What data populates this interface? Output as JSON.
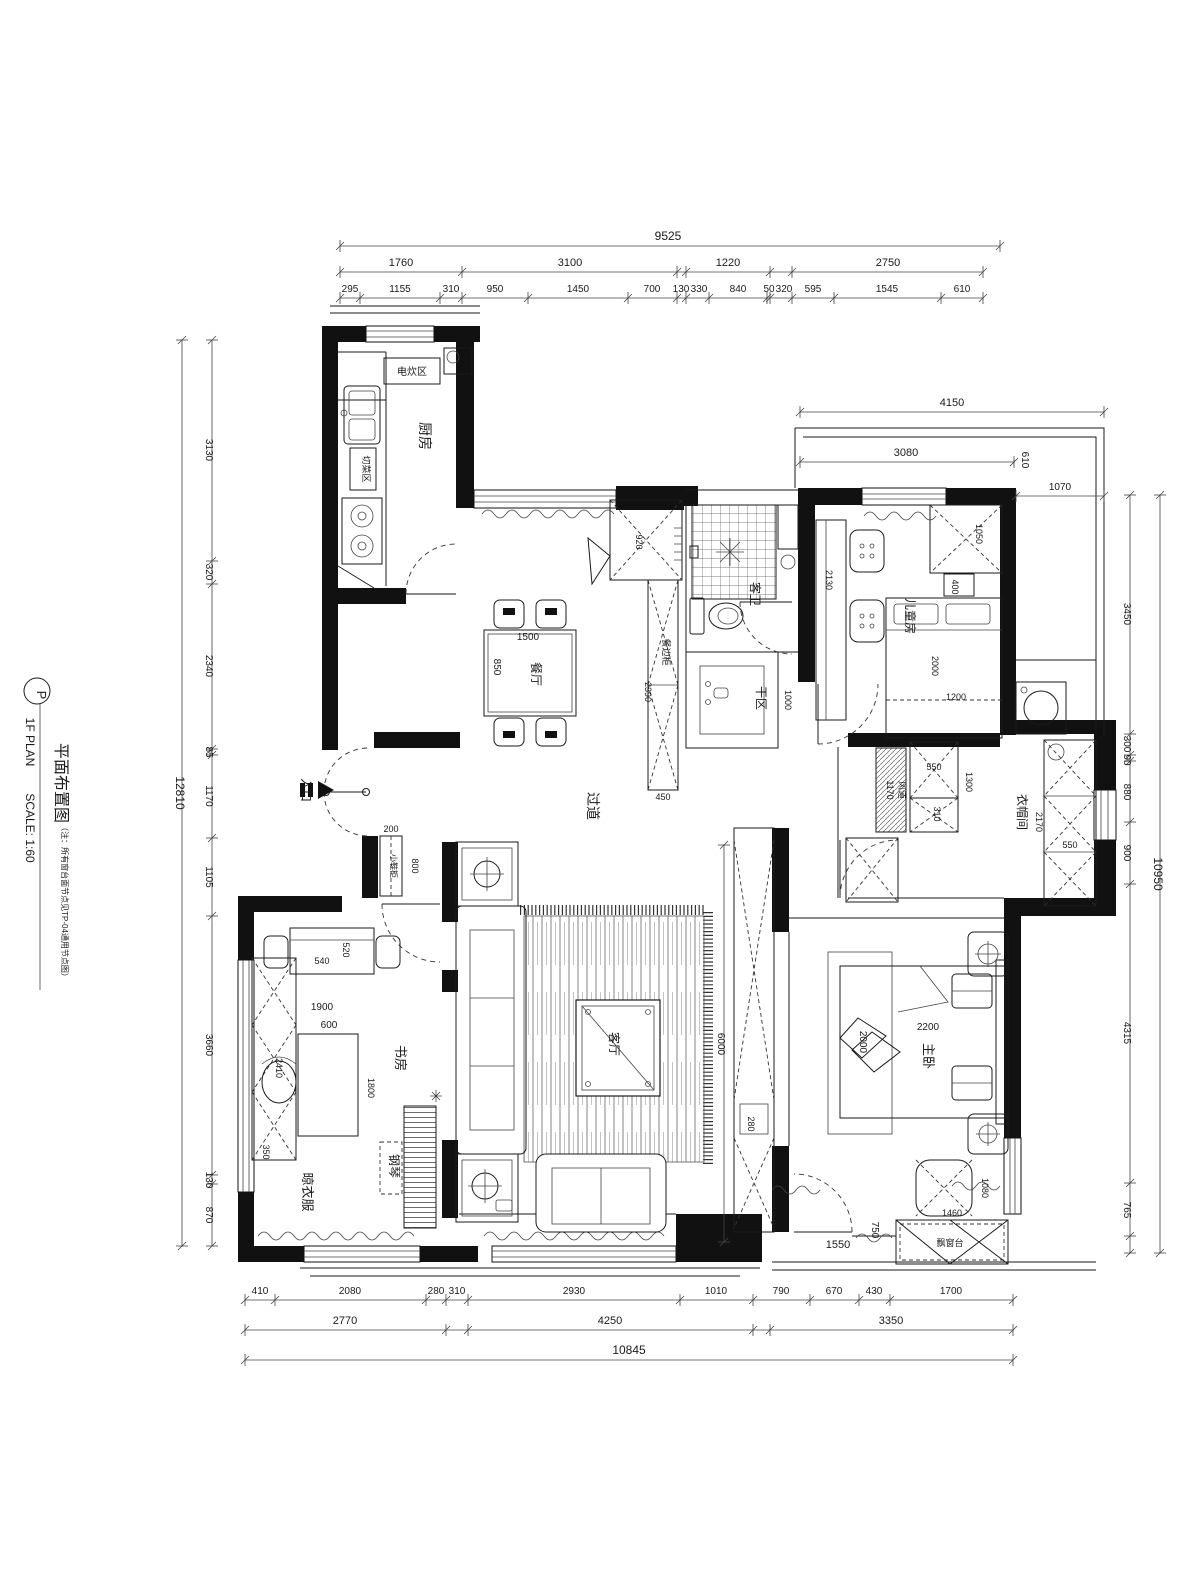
{
  "annotations": {
    "title": [
      {
        "t": "P",
        "x": 37,
        "y": 695,
        "r": 90,
        "s": 13,
        "n": "title-marker-letter"
      },
      {
        "t": "1F PLAN",
        "x": 26,
        "y": 742,
        "r": 90,
        "s": 12,
        "n": "title-line1"
      },
      {
        "t": "SCALE: 1:60",
        "x": 26,
        "y": 828,
        "r": 90,
        "s": 12,
        "n": "title-scale"
      },
      {
        "t": "平面布置图",
        "x": 56,
        "y": 783,
        "r": 90,
        "s": 16,
        "n": "title-cn"
      },
      {
        "t": "（注：所有窗台面节点见TP-04通用节点图）",
        "x": 62,
        "y": 902,
        "r": 90,
        "s": 8,
        "n": "title-note"
      }
    ],
    "rooms": [
      {
        "t": "厨房",
        "x": 420,
        "y": 436,
        "r": 90,
        "s": 14,
        "n": "room-kitchen"
      },
      {
        "t": "电炊区",
        "x": 412,
        "y": 375,
        "r": 0,
        "s": 10,
        "n": "label-cooking-zone"
      },
      {
        "t": "切菜区",
        "x": 363,
        "y": 469,
        "r": 90,
        "s": 9,
        "n": "label-cutting-zone"
      },
      {
        "t": "餐厅",
        "x": 532,
        "y": 674,
        "r": 90,
        "s": 12,
        "n": "room-dining"
      },
      {
        "t": "客卫",
        "x": 751,
        "y": 594,
        "r": 90,
        "s": 12,
        "n": "room-guest-bath"
      },
      {
        "t": "干区",
        "x": 757,
        "y": 698,
        "r": 90,
        "s": 12,
        "n": "room-dry-area"
      },
      {
        "t": "过道",
        "x": 588,
        "y": 806,
        "r": 90,
        "s": 14,
        "n": "room-corridor"
      },
      {
        "t": "入口",
        "x": 302,
        "y": 790,
        "r": 90,
        "s": 12,
        "n": "label-entrance"
      },
      {
        "t": "儿童房",
        "x": 906,
        "y": 616,
        "r": 90,
        "s": 12,
        "n": "room-kids"
      },
      {
        "t": "衣帽间",
        "x": 1018,
        "y": 812,
        "r": 90,
        "s": 12,
        "n": "room-cloakroom"
      },
      {
        "t": "客厅",
        "x": 610,
        "y": 1044,
        "r": 90,
        "s": 12,
        "n": "room-living"
      },
      {
        "t": "书房",
        "x": 396,
        "y": 1058,
        "r": 90,
        "s": 13,
        "n": "room-study"
      },
      {
        "t": "晾衣服",
        "x": 303,
        "y": 1192,
        "r": 90,
        "s": 13,
        "n": "label-laundry"
      },
      {
        "t": "钢琴",
        "x": 390,
        "y": 1166,
        "r": 90,
        "s": 12,
        "n": "label-piano"
      },
      {
        "t": "主卧",
        "x": 924,
        "y": 1056,
        "r": 90,
        "s": 13,
        "n": "room-master"
      },
      {
        "t": "飘窗台",
        "x": 950,
        "y": 1246,
        "r": 0,
        "s": 9,
        "n": "label-bay-window"
      },
      {
        "t": "风道",
        "x": 899,
        "y": 790,
        "r": 90,
        "s": 9,
        "n": "label-air-duct"
      },
      {
        "t": "小鞋柜",
        "x": 391,
        "y": 866,
        "r": 90,
        "s": 8,
        "n": "label-shoe-cabinet"
      },
      {
        "t": "餐边柜",
        "x": 663,
        "y": 652,
        "r": 90,
        "s": 9,
        "n": "label-sideboard"
      }
    ],
    "dims": [
      {
        "t": "920",
        "x": 636,
        "y": 542,
        "r": 90,
        "s": 9,
        "n": "dim-920"
      },
      {
        "t": "1500",
        "x": 528,
        "y": 640,
        "r": 0,
        "s": 10,
        "n": "dim-1500"
      },
      {
        "t": "850",
        "x": 494,
        "y": 667,
        "r": 90,
        "s": 10,
        "n": "dim-850"
      },
      {
        "t": "2390",
        "x": 645,
        "y": 692,
        "r": 90,
        "s": 9,
        "n": "dim-2390"
      },
      {
        "t": "450",
        "x": 663,
        "y": 800,
        "r": 0,
        "s": 9,
        "n": "dim-450"
      },
      {
        "t": "1000",
        "x": 785,
        "y": 700,
        "r": 90,
        "s": 9,
        "n": "dim-1000"
      },
      {
        "t": "2130",
        "x": 826,
        "y": 580,
        "r": 90,
        "s": 9,
        "n": "dim-2130"
      },
      {
        "t": "1050",
        "x": 976,
        "y": 534,
        "r": 90,
        "s": 9,
        "n": "dim-1050"
      },
      {
        "t": "400",
        "x": 952,
        "y": 587,
        "r": 90,
        "s": 9,
        "n": "dim-400"
      },
      {
        "t": "2000",
        "x": 932,
        "y": 666,
        "r": 90,
        "s": 9,
        "n": "dim-2000-kids"
      },
      {
        "t": "1200",
        "x": 956,
        "y": 700,
        "r": 0,
        "s": 9,
        "n": "dim-1200"
      },
      {
        "t": "200",
        "x": 391,
        "y": 832,
        "r": 0,
        "s": 9,
        "n": "dim-200"
      },
      {
        "t": "800",
        "x": 412,
        "y": 866,
        "r": 90,
        "s": 9,
        "n": "dim-800"
      },
      {
        "t": "540",
        "x": 322,
        "y": 964,
        "r": 0,
        "s": 9,
        "n": "dim-540"
      },
      {
        "t": "520",
        "x": 343,
        "y": 950,
        "r": 90,
        "s": 9,
        "n": "dim-520"
      },
      {
        "t": "1900",
        "x": 322,
        "y": 1010,
        "r": 0,
        "s": 10,
        "n": "dim-1900"
      },
      {
        "t": "600",
        "x": 329,
        "y": 1028,
        "r": 0,
        "s": 10,
        "n": "dim-600"
      },
      {
        "t": "1800",
        "x": 368,
        "y": 1088,
        "r": 90,
        "s": 9,
        "n": "dim-1800"
      },
      {
        "t": "2410",
        "x": 276,
        "y": 1068,
        "r": 90,
        "s": 9,
        "n": "dim-2410"
      },
      {
        "t": "350",
        "x": 263,
        "y": 1152,
        "r": 90,
        "s": 9,
        "n": "dim-350"
      },
      {
        "t": "550",
        "x": 934,
        "y": 770,
        "r": 0,
        "s": 9,
        "n": "dim-550-a"
      },
      {
        "t": "1300",
        "x": 966,
        "y": 782,
        "r": 90,
        "s": 9,
        "n": "dim-1300"
      },
      {
        "t": "310",
        "x": 934,
        "y": 814,
        "r": 90,
        "s": 9,
        "n": "dim-310"
      },
      {
        "t": "1170",
        "x": 887,
        "y": 790,
        "r": 90,
        "s": 9,
        "n": "dim-1170"
      },
      {
        "t": "2170",
        "x": 1036,
        "y": 822,
        "r": 90,
        "s": 9,
        "n": "dim-2170"
      },
      {
        "t": "550",
        "x": 1070,
        "y": 848,
        "r": 0,
        "s": 9,
        "n": "dim-550-b"
      },
      {
        "t": "280",
        "x": 748,
        "y": 1124,
        "r": 90,
        "s": 9,
        "n": "dim-280"
      },
      {
        "t": "2200",
        "x": 928,
        "y": 1030,
        "r": 0,
        "s": 10,
        "n": "dim-2200"
      },
      {
        "t": "2000",
        "x": 860,
        "y": 1042,
        "r": 90,
        "s": 10,
        "n": "dim-2000-master"
      },
      {
        "t": "1080",
        "x": 982,
        "y": 1188,
        "r": 90,
        "s": 9,
        "n": "dim-1080"
      },
      {
        "t": "1460",
        "x": 952,
        "y": 1216,
        "r": 0,
        "s": 9,
        "n": "dim-1460"
      },
      {
        "t": "1550",
        "x": 838,
        "y": 1248,
        "r": 0,
        "s": 11,
        "n": "dim-1550"
      },
      {
        "t": "750",
        "x": 872,
        "y": 1230,
        "r": 90,
        "s": 10,
        "n": "dim-750"
      }
    ]
  },
  "dim_chains": [
    {
      "n": "chain-top-overall",
      "o": "h",
      "p": 246,
      "a": 340,
      "b": 1000,
      "ticks": [
        340,
        1000
      ],
      "labels": [
        {
          "t": "9525",
          "x": 668,
          "y": 240,
          "s": 12
        }
      ]
    },
    {
      "n": "chain-top-mid",
      "o": "h",
      "p": 272,
      "a": 340,
      "b": 983,
      "ticks": [
        340,
        462,
        677,
        686,
        770,
        792,
        983
      ],
      "labels": [
        {
          "t": "1760",
          "x": 401,
          "y": 266,
          "s": 11
        },
        {
          "t": "3100",
          "x": 570,
          "y": 266,
          "s": 11
        },
        {
          "t": "1220",
          "x": 728,
          "y": 266,
          "s": 11
        },
        {
          "t": "2750",
          "x": 888,
          "y": 266,
          "s": 11
        }
      ]
    },
    {
      "n": "chain-top-detail",
      "o": "h",
      "p": 298,
      "a": 340,
      "b": 983,
      "ticks": [
        340,
        360,
        440,
        462,
        528,
        628,
        677,
        686,
        709,
        767,
        770,
        792,
        834,
        941,
        983
      ],
      "labels": [
        {
          "t": "295",
          "x": 350,
          "y": 292,
          "s": 10
        },
        {
          "t": "1155",
          "x": 400,
          "y": 292,
          "s": 10
        },
        {
          "t": "310",
          "x": 451,
          "y": 292,
          "s": 10
        },
        {
          "t": "950",
          "x": 495,
          "y": 292,
          "s": 10
        },
        {
          "t": "1450",
          "x": 578,
          "y": 292,
          "s": 10
        },
        {
          "t": "700",
          "x": 652,
          "y": 292,
          "s": 10
        },
        {
          "t": "130",
          "x": 681,
          "y": 292,
          "s": 10
        },
        {
          "t": "330",
          "x": 699,
          "y": 292,
          "s": 10
        },
        {
          "t": "840",
          "x": 738,
          "y": 292,
          "s": 10
        },
        {
          "t": "50",
          "x": 769,
          "y": 292,
          "s": 10
        },
        {
          "t": "320",
          "x": 784,
          "y": 292,
          "s": 10
        },
        {
          "t": "595",
          "x": 813,
          "y": 292,
          "s": 10
        },
        {
          "t": "1545",
          "x": 887,
          "y": 292,
          "s": 10
        },
        {
          "t": "610",
          "x": 962,
          "y": 292,
          "s": 10
        }
      ]
    },
    {
      "n": "chain-left-overall",
      "o": "v",
      "p": 182,
      "a": 340,
      "b": 1246,
      "ticks": [
        340,
        1246
      ],
      "labels": [
        {
          "t": "12810",
          "x": 176,
          "y": 793,
          "r": 90,
          "s": 12
        }
      ]
    },
    {
      "n": "chain-left-detail",
      "o": "v",
      "p": 212,
      "a": 340,
      "b": 1246,
      "ticks": [
        340,
        561,
        584,
        749,
        755,
        838,
        916,
        1175,
        1184,
        1246
      ],
      "labels": [
        {
          "t": "3130",
          "x": 206,
          "y": 450,
          "r": 90,
          "s": 10
        },
        {
          "t": "320",
          "x": 206,
          "y": 572,
          "r": 90,
          "s": 10
        },
        {
          "t": "2340",
          "x": 206,
          "y": 666,
          "r": 90,
          "s": 10
        },
        {
          "t": "85",
          "x": 206,
          "y": 752,
          "r": 90,
          "s": 10
        },
        {
          "t": "1170",
          "x": 206,
          "y": 796,
          "r": 90,
          "s": 10
        },
        {
          "t": "1105",
          "x": 206,
          "y": 877,
          "r": 90,
          "s": 10
        },
        {
          "t": "3660",
          "x": 206,
          "y": 1045,
          "r": 90,
          "s": 10
        },
        {
          "t": "130",
          "x": 206,
          "y": 1180,
          "r": 90,
          "s": 10
        },
        {
          "t": "870",
          "x": 206,
          "y": 1215,
          "r": 90,
          "s": 10
        }
      ]
    },
    {
      "n": "chain-right-detail",
      "o": "v",
      "p": 1130,
      "a": 495,
      "b": 1253,
      "ticks": [
        495,
        734,
        755,
        761,
        822,
        884,
        1183,
        1236,
        1253
      ],
      "labels": [
        {
          "t": "3450",
          "x": 1124,
          "y": 614,
          "r": 90,
          "s": 10
        },
        {
          "t": "300",
          "x": 1124,
          "y": 744,
          "r": 90,
          "s": 10
        },
        {
          "t": "90",
          "x": 1124,
          "y": 760,
          "r": 90,
          "s": 10
        },
        {
          "t": "880",
          "x": 1124,
          "y": 792,
          "r": 90,
          "s": 10
        },
        {
          "t": "900",
          "x": 1124,
          "y": 853,
          "r": 90,
          "s": 10
        },
        {
          "t": "4315",
          "x": 1124,
          "y": 1033,
          "r": 90,
          "s": 10
        },
        {
          "t": "765",
          "x": 1124,
          "y": 1210,
          "r": 90,
          "s": 10
        }
      ]
    },
    {
      "n": "chain-right-overall",
      "o": "v",
      "p": 1160,
      "a": 495,
      "b": 1253,
      "ticks": [
        495,
        1253
      ],
      "labels": [
        {
          "t": "10950",
          "x": 1154,
          "y": 874,
          "r": 90,
          "s": 12
        }
      ]
    },
    {
      "n": "chain-bottom-detail",
      "o": "h",
      "p": 1300,
      "a": 245,
      "b": 1013,
      "ticks": [
        245,
        275,
        426,
        446,
        468,
        680,
        753,
        810,
        859,
        890,
        1013
      ],
      "labels": [
        {
          "t": "410",
          "x": 260,
          "y": 1294,
          "s": 10
        },
        {
          "t": "2080",
          "x": 350,
          "y": 1294,
          "s": 10
        },
        {
          "t": "280",
          "x": 436,
          "y": 1294,
          "s": 10
        },
        {
          "t": "310",
          "x": 457,
          "y": 1294,
          "s": 10
        },
        {
          "t": "2930",
          "x": 574,
          "y": 1294,
          "s": 10
        },
        {
          "t": "1010",
          "x": 716,
          "y": 1294,
          "s": 10
        },
        {
          "t": "790",
          "x": 781,
          "y": 1294,
          "s": 10
        },
        {
          "t": "670",
          "x": 834,
          "y": 1294,
          "s": 10
        },
        {
          "t": "430",
          "x": 874,
          "y": 1294,
          "s": 10
        },
        {
          "t": "1700",
          "x": 951,
          "y": 1294,
          "s": 10
        }
      ]
    },
    {
      "n": "chain-bottom-mid",
      "o": "h",
      "p": 1330,
      "a": 245,
      "b": 1013,
      "ticks": [
        245,
        446,
        468,
        753,
        770,
        1013
      ],
      "labels": [
        {
          "t": "2770",
          "x": 345,
          "y": 1324,
          "s": 11
        },
        {
          "t": "4250",
          "x": 610,
          "y": 1324,
          "s": 11
        },
        {
          "t": "3350",
          "x": 891,
          "y": 1324,
          "s": 11
        }
      ]
    },
    {
      "n": "chain-bottom-overall",
      "o": "h",
      "p": 1360,
      "a": 245,
      "b": 1013,
      "ticks": [
        245,
        1013
      ],
      "labels": [
        {
          "t": "10845",
          "x": 629,
          "y": 1354,
          "s": 12
        }
      ]
    },
    {
      "n": "chain-balcony-4150",
      "o": "h",
      "p": 412,
      "a": 800,
      "b": 1104,
      "ticks": [
        800,
        1104
      ],
      "labels": [
        {
          "t": "4150",
          "x": 952,
          "y": 406,
          "s": 11
        }
      ]
    },
    {
      "n": "chain-balcony-3080",
      "o": "h",
      "p": 462,
      "a": 800,
      "b": 1014,
      "ticks": [
        800,
        1014
      ],
      "labels": [
        {
          "t": "3080",
          "x": 906,
          "y": 456,
          "s": 11
        },
        {
          "t": "610",
          "x": 1022,
          "y": 460,
          "r": 90,
          "s": 10
        }
      ]
    },
    {
      "n": "chain-balcony-1070",
      "o": "h",
      "p": 496,
      "a": 1016,
      "b": 1104,
      "ticks": [
        1016,
        1104
      ],
      "labels": [
        {
          "t": "1070",
          "x": 1060,
          "y": 490,
          "s": 10
        }
      ]
    },
    {
      "n": "chain-living-6000",
      "o": "v",
      "p": 724,
      "a": 845,
      "b": 1242,
      "ticks": [
        845,
        1242
      ],
      "labels": [
        {
          "t": "6000",
          "x": 718,
          "y": 1044,
          "r": 90,
          "s": 10
        }
      ]
    }
  ]
}
